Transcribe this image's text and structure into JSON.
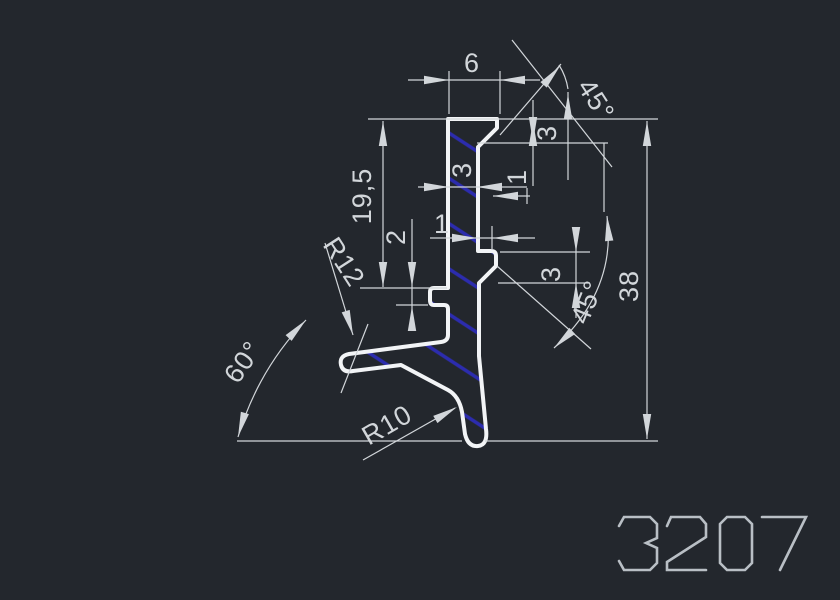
{
  "drawing": {
    "title": "3207",
    "type": "cad-profile-cross-section",
    "background": "#23272d",
    "line_color": "#d2d6da",
    "outline_color": "#f2f4f6",
    "hatch_color": "#2c2cae",
    "text_color": "#d2d6da",
    "part_number_color": "#b9bfc5",
    "profile_path": "M 448,119 L 497,119 L 497,128 L 478,147 L 478,251 L 491,251 Q 496,251 496,256 L 496,266 L 479,283 L 479,356 L 486,429 Q 488,445 478,446 Q 468,447 465,434 L 462,412 Q 459,396 448,390 L 401,365 L 353,371 Q 343,373 341,365 Q 339,356 349,354 L 441,342 Q 448,341 448,335 L 448,309 Q 448,305 444,305 L 434,305 Q 430,305 430,300 L 430,292 Q 430,288 434,288 L 448,288 Z",
    "hatch": {
      "angle": 33,
      "spacing": 38,
      "stroke_width": 3.5
    },
    "dimension_labels": [
      {
        "id": "dim-top-width",
        "label": "6",
        "x": 472,
        "y": 63,
        "rot": 0
      },
      {
        "id": "dim-top-chamfer-angle",
        "label": "45°",
        "x": 596,
        "y": 100,
        "rot": 57
      },
      {
        "id": "dim-top-chamfer-height",
        "label": "3",
        "x": 547,
        "y": 133,
        "rot": -90
      },
      {
        "id": "dim-top-offset",
        "label": "1",
        "x": 517,
        "y": 177,
        "rot": -90
      },
      {
        "id": "dim-stem-width",
        "label": "3",
        "x": 462,
        "y": 170,
        "rot": -90
      },
      {
        "id": "dim-mid-offset",
        "label": "1",
        "x": 442,
        "y": 224,
        "rot": 0
      },
      {
        "id": "dim-height-upper",
        "label": "19,5",
        "x": 362,
        "y": 196,
        "rot": -90
      },
      {
        "id": "dim-notch-height",
        "label": "2",
        "x": 396,
        "y": 237,
        "rot": -90
      },
      {
        "id": "radius-r12",
        "label": "R12",
        "x": 344,
        "y": 262,
        "rot": 57
      },
      {
        "id": "dim-lug-height",
        "label": "3",
        "x": 551,
        "y": 274,
        "rot": -90
      },
      {
        "id": "dim-lug-chamfer-angle",
        "label": "45°",
        "x": 587,
        "y": 302,
        "rot": -68
      },
      {
        "id": "dim-total-height",
        "label": "38",
        "x": 629,
        "y": 286,
        "rot": -90
      },
      {
        "id": "dim-leg-angle",
        "label": "60°",
        "x": 243,
        "y": 362,
        "rot": -55
      },
      {
        "id": "radius-r10",
        "label": "R10",
        "x": 387,
        "y": 425,
        "rot": -30
      }
    ],
    "lines": [
      [
        368,
        119,
        658,
        119
      ],
      [
        449,
        71,
        449,
        114
      ],
      [
        500,
        71,
        500,
        114
      ],
      [
        408,
        80,
        540,
        80
      ],
      [
        500,
        135,
        561,
        64
      ],
      [
        512,
        40,
        612,
        167
      ],
      [
        533,
        100,
        533,
        186
      ],
      [
        477,
        143,
        608,
        143
      ],
      [
        568,
        92,
        568,
        180
      ],
      [
        604,
        143,
        604,
        212
      ],
      [
        418,
        187,
        527,
        187
      ],
      [
        493,
        196,
        530,
        196
      ],
      [
        527,
        188,
        527,
        204
      ],
      [
        492,
        226,
        492,
        250
      ],
      [
        430,
        238,
        535,
        238
      ],
      [
        500,
        252,
        590,
        252
      ],
      [
        498,
        283,
        590,
        283
      ],
      [
        576,
        230,
        576,
        318
      ],
      [
        497,
        266,
        591,
        349
      ],
      [
        383,
        121,
        383,
        287
      ],
      [
        360,
        288,
        447,
        288
      ],
      [
        412,
        219,
        412,
        330
      ],
      [
        396,
        305,
        428,
        305
      ],
      [
        325,
        243,
        353,
        335
      ],
      [
        368,
        324,
        341,
        393
      ],
      [
        237,
        441,
        462,
        441
      ],
      [
        485,
        441,
        658,
        441
      ],
      [
        647,
        121,
        647,
        439
      ],
      [
        363,
        460,
        455,
        408
      ]
    ],
    "arcs": [
      "M 607,216 Q 617,290 554,348",
      "M 238,437 Q 258,370 306,320",
      "M 559,65 Q 566,76 568,89"
    ],
    "arrows": [
      [
        449,
        80,
        0
      ],
      [
        500,
        80,
        180
      ],
      [
        560,
        66,
        -49
      ],
      [
        533,
        121,
        -90
      ],
      [
        533,
        142,
        90
      ],
      [
        568,
        94,
        -90
      ],
      [
        607,
        216,
        -95
      ],
      [
        554,
        348,
        137
      ],
      [
        576,
        252,
        90
      ],
      [
        576,
        283,
        -90
      ],
      [
        383,
        121,
        -90
      ],
      [
        383,
        287,
        90
      ],
      [
        412,
        287,
        90
      ],
      [
        412,
        306,
        -90
      ],
      [
        353,
        335,
        73
      ],
      [
        238,
        437,
        106
      ],
      [
        306,
        320,
        -46
      ],
      [
        457,
        407,
        -30
      ],
      [
        647,
        121,
        -90
      ],
      [
        647,
        439,
        90
      ],
      [
        477,
        238,
        0
      ],
      [
        493,
        238,
        180
      ],
      [
        493,
        196,
        180
      ],
      [
        449,
        187,
        0
      ],
      [
        477,
        187,
        180
      ]
    ],
    "part_number": {
      "label": "3207",
      "strokes": [
        "M 619,526 L 624,517 L 650,517 L 657,524 L 657,538 L 646,543 L 657,548 L 657,563 L 650,570 L 624,570 L 619,561",
        "M 667,526 L 671,517 L 700,517 L 706,524 L 706,537 L 667,562 L 667,570 L 706,570",
        "M 727,517 L 745,517 L 752,524 L 752,563 L 745,570 L 727,570 L 720,563 L 720,524 Z",
        "M 762,517 L 806,517 L 780,570"
      ]
    }
  }
}
